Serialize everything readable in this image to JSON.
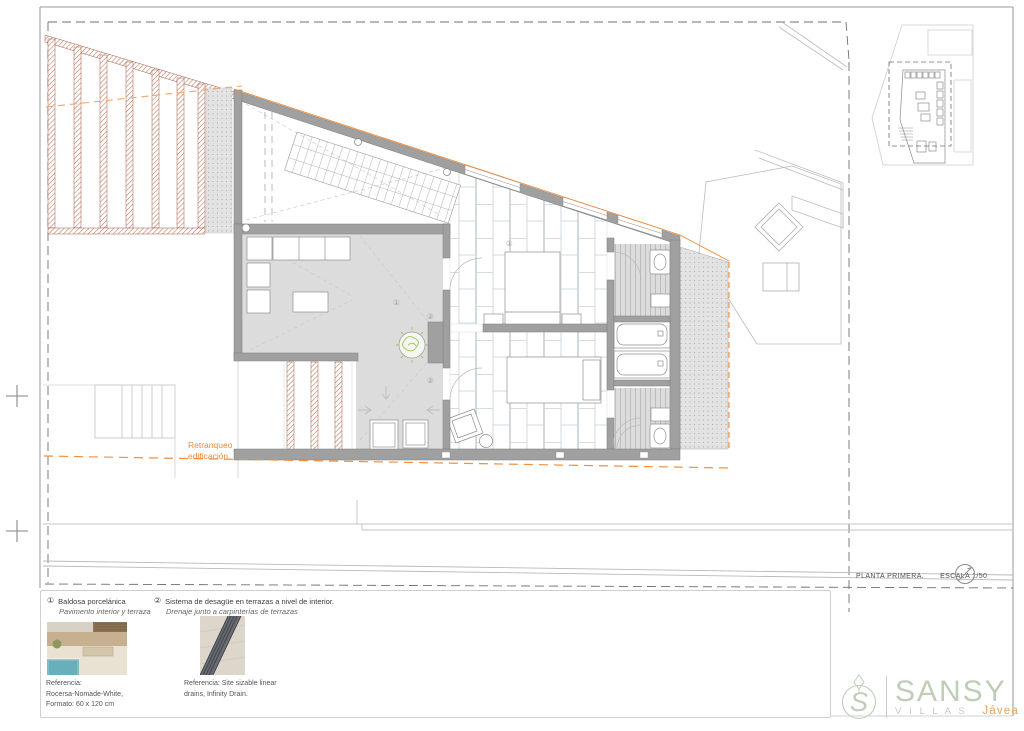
{
  "plan": {
    "setback_line1": "Retranqueo",
    "setback_line2": "edificación",
    "marker_1": "①",
    "marker_2": "②"
  },
  "titleblock": {
    "title": "PLANTA PRIMERA.",
    "scale": "ESCALA 1/50"
  },
  "legend": {
    "note1": {
      "num": "①",
      "title": "Baldosa porcelánica",
      "subtitle": "Pavimento interior y terraza",
      "ref1": "Referencia:",
      "ref2": "Rocersa-Nomade-White,",
      "ref3": "Formato: 60 x 120 cm"
    },
    "note2": {
      "num": "②",
      "title": "Sistema de desagüe en terrazas a nivel de interior.",
      "subtitle": "Drenaje junto a carpinterías de terrazas",
      "ref1": "Referencia: Site sizable linear",
      "ref2": "drains, Infinity Drain."
    }
  },
  "logo": {
    "monogram": "S",
    "name": "SANSY",
    "tagline": "V I L L A S",
    "location": "Jávea"
  },
  "colors": {
    "setback_orange": "#EF8A38",
    "hatch_terracotta": "#BF7257",
    "wall_gray": "#A0A0A0",
    "floor_gray": "#DCDCDC",
    "logo_green": "#BFCDB9",
    "logo_orange": "#E8A35F"
  }
}
